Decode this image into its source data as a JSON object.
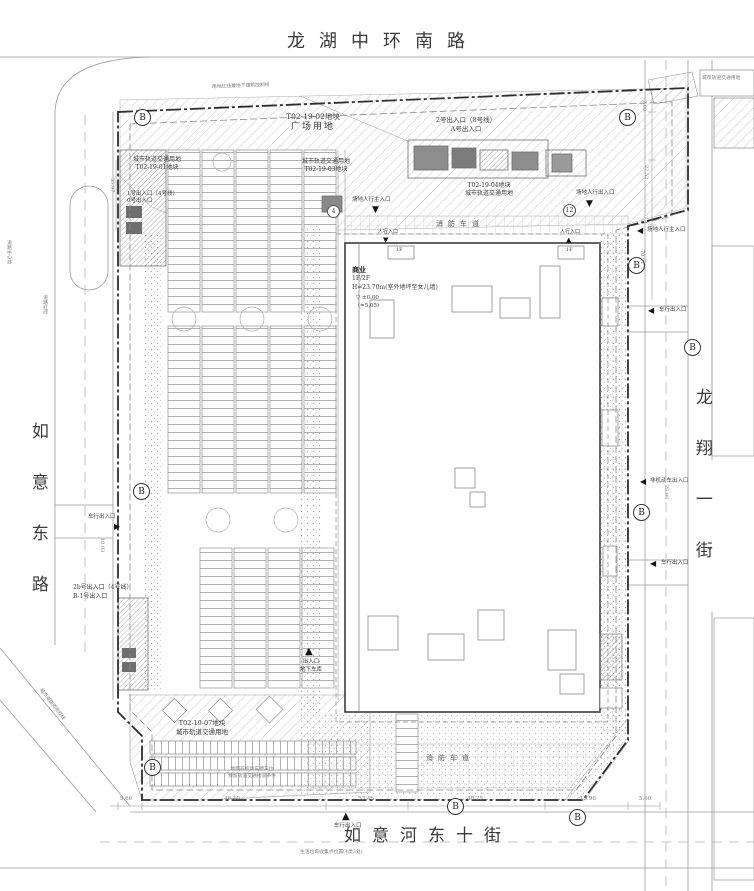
{
  "streets": {
    "top": "龙湖中环南路",
    "left": "如意东路",
    "right": "龙翔一街",
    "bottom": "如意河东十街"
  },
  "parcels": {
    "plaza": {
      "code": "T02-19-02地块",
      "use": "广场用地"
    },
    "metro01": {
      "use": "城市轨道交通用地",
      "code": "T02-19-01地块"
    },
    "metro03": {
      "use": "城市轨道交通用地",
      "code": "T02-19-03地块"
    },
    "metro04": {
      "code": "T02-19-04地块",
      "use": "城市轨道交通用地"
    },
    "metro07": {
      "code": "T02-19-07地块",
      "use": "城市轨道交通用地"
    }
  },
  "building": {
    "use": "商业",
    "floors": "1F/2F",
    "height": "H=23.70m(室外地坪至女儿墙)",
    "level": "▽ ±0.00",
    "elevation": "(=5.05)",
    "floor_tag": "1F"
  },
  "entrances": {
    "metro1": {
      "line1": "1号出入口（4号线）",
      "line2": "0号出入口"
    },
    "metro2": {
      "line1": "2号出入口（8号线）",
      "line2": "A号出入口"
    },
    "metro2b": {
      "line1": "2b号出入口（4号线）",
      "line2": "B-1号出入口"
    },
    "ped_main_top": "场地人行主入口",
    "ped_top_right": "场地人行出入口",
    "ped_small": "人行入口",
    "ped_main_right": "场地人行主入口",
    "veh": "车行出入口",
    "nonmotor": "非机动车出入口",
    "garage_line1": "出入口",
    "garage_line2": "地下车库"
  },
  "fire_lane": "消防车道",
  "markers": {
    "section": "B",
    "node4": "4",
    "node12": "12"
  },
  "dimensions": {
    "bottom": [
      "5.66",
      "46.40",
      "53.46",
      "48.25",
      "15.96",
      "5.00"
    ],
    "right": [
      "7.00",
      "22.52",
      "70.91",
      "75.06"
    ],
    "left": [
      "35.97",
      "10.93"
    ]
  },
  "notes": {
    "boundary_top": "用地红线兼地下建筑控制线",
    "parking1": "地面非机动车停车位",
    "parking2": "预留轨道交通接驳条件",
    "trash": "生活垃圾收集点位置(4类3处)",
    "corner": "城市道路用地红线",
    "right_box": "城市轨道交通用地",
    "centerline": "道路中心线",
    "redline": "道路红线"
  }
}
